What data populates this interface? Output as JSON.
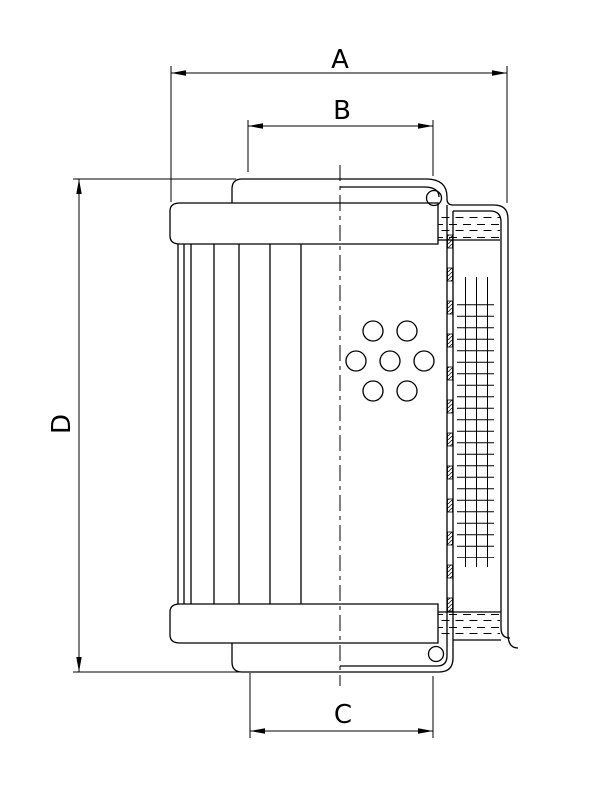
{
  "drawing": {
    "type": "technical-drawing",
    "subject": "hydraulic-filter-element-cross-section",
    "background_color": "#ffffff",
    "line_color": "#000000",
    "dimensions": {
      "a": {
        "label": "A",
        "orientation": "horizontal",
        "measures": "outer-cap-width"
      },
      "b": {
        "label": "B",
        "orientation": "horizontal",
        "measures": "top-spigot-width"
      },
      "c": {
        "label": "C",
        "orientation": "horizontal",
        "measures": "bottom-spigot-width"
      },
      "d": {
        "label": "D",
        "orientation": "vertical",
        "measures": "overall-height"
      }
    }
  }
}
